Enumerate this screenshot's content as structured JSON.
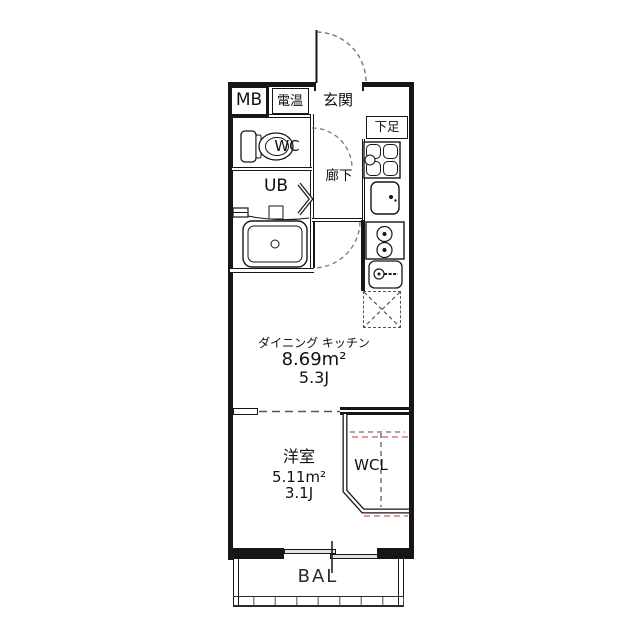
{
  "fp": {
    "meter_box": {
      "label": "MB"
    },
    "water_heater": {
      "label": "電温"
    },
    "entrance": {
      "label": "玄関"
    },
    "shoe_box": {
      "label": "下足"
    },
    "wc": {
      "label": "WC"
    },
    "corridor": {
      "label": "廊下"
    },
    "unit_bath": {
      "label": "UB"
    },
    "dining_kitchen": {
      "label": "ダイニング キッチン",
      "area": "8.69m²",
      "tatami": "5.3J"
    },
    "bedroom": {
      "label": "洋室",
      "area": "5.11m²",
      "tatami": "3.1J"
    },
    "closet": {
      "label": "WCL"
    },
    "balcony": {
      "label": "BAL"
    },
    "colors": {
      "line": "#161616",
      "door_arc": "#777777",
      "closet_dash": "#888888",
      "closet_accent": "#e49898",
      "window_fill": "#e2e2e2"
    }
  }
}
